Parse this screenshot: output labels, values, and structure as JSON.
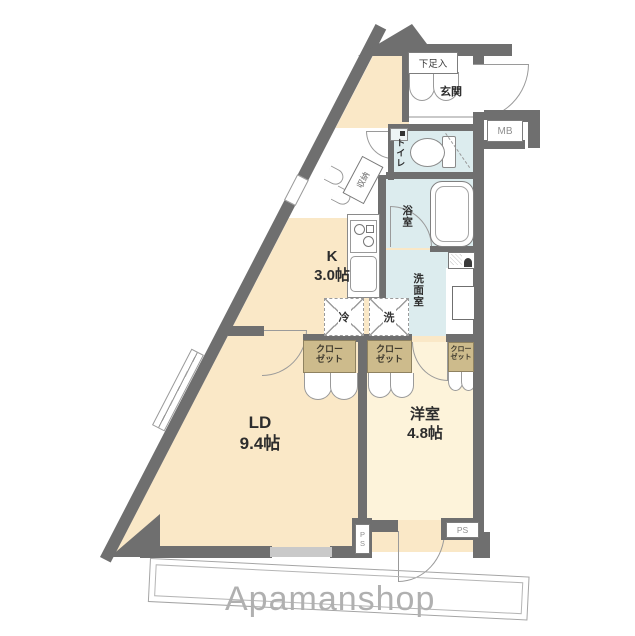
{
  "rooms": {
    "kitchen": {
      "name": "K",
      "size": "3.0帖"
    },
    "living": {
      "name": "LD",
      "size": "9.4帖"
    },
    "western": {
      "name": "洋室",
      "size": "4.8帖"
    },
    "bath": "浴室",
    "washroom": "洗面室",
    "toilet": "トイレ",
    "entrance": "玄関",
    "shoe_cabinet": "下足入",
    "storage": "収納"
  },
  "fixtures": {
    "refrigerator": "冷",
    "washer": "洗"
  },
  "closets": [
    {
      "line1": "クロー",
      "line2": "ゼット"
    },
    {
      "line1": "クロー",
      "line2": "ゼット"
    },
    {
      "line1": "クロー",
      "line2": "ゼット"
    }
  ],
  "labels": {
    "meter_box": "MB",
    "pipe_space_left": "PS",
    "pipe_space_right": "PS"
  },
  "watermark": "Apamanshop",
  "colors": {
    "wall": "#6f6f6f",
    "floor_main": "#fae8c7",
    "floor_western": "#fdf3da",
    "floor_wet": "#dcecee",
    "closet": "#cdbb8c",
    "watermark": "#b0b0b0",
    "window": "#c9c9c9"
  }
}
